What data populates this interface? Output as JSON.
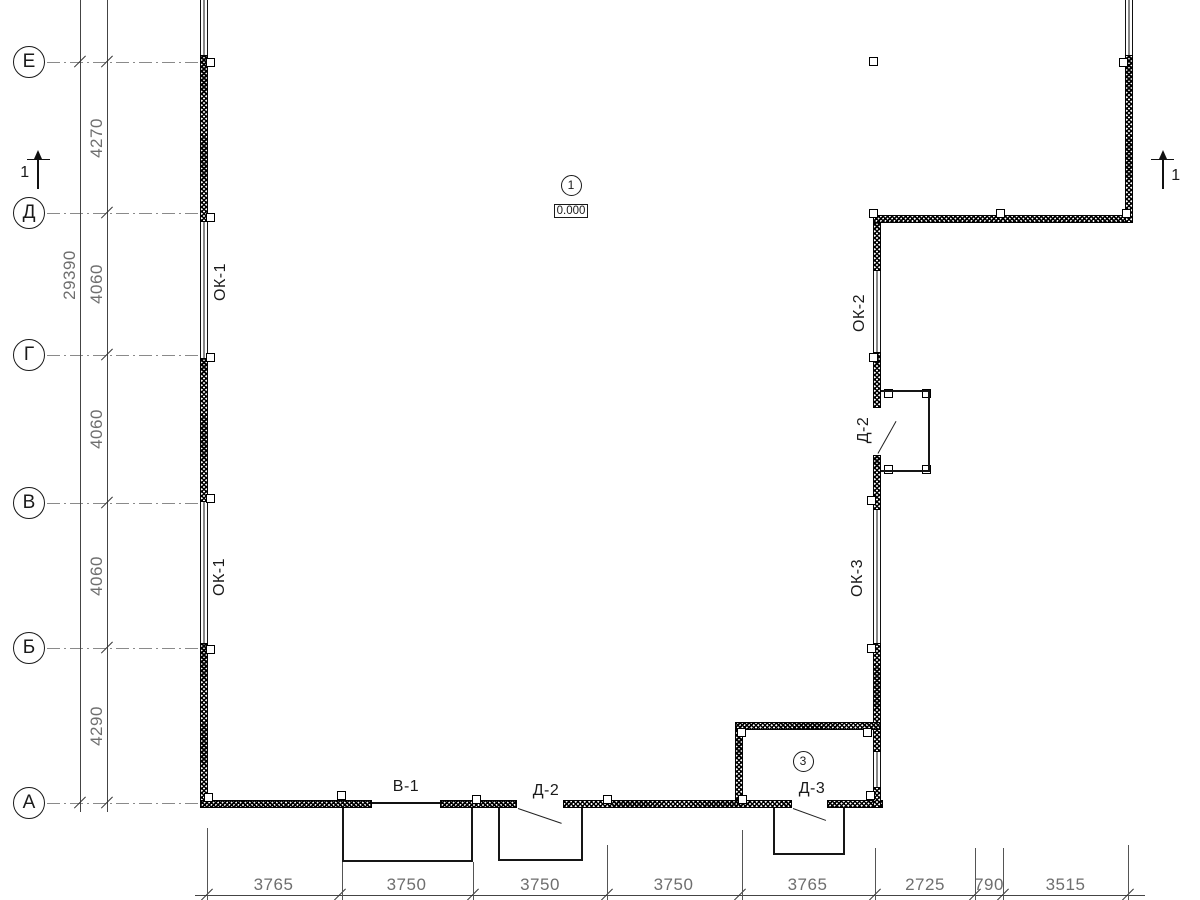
{
  "app": {
    "type": "architectural-floor-plan",
    "sheet_background": "#ffffff"
  },
  "plan": {
    "canvas": {
      "width": 1200,
      "height": 900,
      "ink": "#1a1a1a",
      "dim_color": "#6e6e6e",
      "axis_color": "#8a8a8a"
    },
    "axes": {
      "cx": 29,
      "r": 16,
      "line_x1": 47,
      "line_x2": 202,
      "items": [
        {
          "label": "Е",
          "y": 62
        },
        {
          "label": "Д",
          "y": 213
        },
        {
          "label": "Г",
          "y": 355
        },
        {
          "label": "В",
          "y": 503
        },
        {
          "label": "Б",
          "y": 648
        },
        {
          "label": "А",
          "y": 803
        }
      ]
    },
    "v_dims": {
      "line_x": 107,
      "bottom": 812,
      "text_x": 97,
      "ticks": [
        62,
        213,
        355,
        503,
        648,
        803
      ],
      "values": [
        "4270",
        "4060",
        "4060",
        "4060",
        "4290"
      ],
      "total": {
        "line_x": 80,
        "value": "29390",
        "text_cx": 70,
        "text_cy": 275,
        "ticks": [
          62,
          803
        ]
      }
    },
    "h_dims": {
      "line": [
        195,
        895,
        950
      ],
      "text_y": 885,
      "ticks": [
        207,
        340,
        473,
        607,
        740,
        875,
        975,
        1003,
        1128
      ],
      "values": [
        "3765",
        "3750",
        "3750",
        "3750",
        "3765",
        "2725",
        "790",
        "3515"
      ]
    },
    "section_marks": [
      {
        "label": "1",
        "bar": [
          27,
          158.5,
          23
        ],
        "line_x": 38,
        "line_y1": 150,
        "line_y2": 189,
        "label_cx": 25,
        "label_cy": 173
      },
      {
        "label": "1",
        "bar": [
          1151,
          158.5,
          23
        ],
        "line_x": 1163,
        "line_y1": 150,
        "line_y2": 189,
        "label_cx": 1176,
        "label_cy": 176
      }
    ],
    "level_mark": {
      "bubble_label": "1",
      "cx": 571,
      "cy": 185,
      "r": 10.5,
      "box": [
        554,
        204,
        34,
        14
      ],
      "elevation": "0.000"
    },
    "room_mark": {
      "label": "3",
      "cx": 803,
      "cy": 761,
      "r": 10.5
    },
    "labels": [
      {
        "name": "window-label-ok1-upper",
        "text": "ОК-1",
        "cx": 221,
        "cy": 282,
        "rot": -90
      },
      {
        "name": "window-label-ok1-lower",
        "text": "ОК-1",
        "cx": 220,
        "cy": 577,
        "rot": -90
      },
      {
        "name": "window-label-ok2",
        "text": "ОК-2",
        "cx": 860,
        "cy": 313,
        "rot": -90
      },
      {
        "name": "window-label-ok3",
        "text": "ОК-3",
        "cx": 858,
        "cy": 578,
        "rot": -90
      },
      {
        "name": "door-label-v1",
        "text": "В-1",
        "cx": 406,
        "cy": 787,
        "rot": 0
      },
      {
        "name": "door-label-d2-bottom",
        "text": "Д-2",
        "cx": 546,
        "cy": 791,
        "rot": 0
      },
      {
        "name": "door-label-d3",
        "text": "Д-3",
        "cx": 812,
        "cy": 789,
        "rot": 0
      },
      {
        "name": "door-label-d2-right",
        "text": "Д-2",
        "cx": 864,
        "cy": 430,
        "rot": -90
      }
    ],
    "walls": [
      [
        200,
        55,
        8,
        167
      ],
      [
        200,
        358,
        8,
        144
      ],
      [
        200,
        643,
        8,
        165
      ],
      [
        200,
        800,
        172,
        8
      ],
      [
        440,
        800,
        77,
        8
      ],
      [
        563,
        800,
        229,
        8
      ],
      [
        827,
        800,
        56,
        8
      ],
      [
        873,
        215,
        8,
        56
      ],
      [
        873,
        352,
        8,
        56
      ],
      [
        873,
        455,
        8,
        55
      ],
      [
        873,
        643,
        8,
        109
      ],
      [
        873,
        787,
        8,
        21
      ],
      [
        873,
        215,
        260,
        8
      ],
      [
        1125,
        55,
        8,
        168
      ],
      [
        735,
        722,
        146,
        8
      ],
      [
        735,
        730,
        8,
        70
      ]
    ],
    "windows": [
      {
        "name": "window-top-left",
        "r": [
          200,
          0,
          8,
          55
        ]
      },
      {
        "name": "window-ok1-upper",
        "r": [
          200,
          222,
          8,
          136
        ]
      },
      {
        "name": "window-ok1-lower",
        "r": [
          200,
          502,
          8,
          141
        ]
      },
      {
        "name": "window-ok2",
        "r": [
          873,
          271,
          8,
          81
        ]
      },
      {
        "name": "window-ok3",
        "r": [
          873,
          510,
          8,
          133
        ]
      },
      {
        "name": "window-vestibule",
        "r": [
          873,
          752,
          8,
          35
        ]
      },
      {
        "name": "window-top-right",
        "r": [
          1125,
          0,
          8,
          55
        ]
      }
    ],
    "columns": [
      [
        210,
        62
      ],
      [
        210,
        217
      ],
      [
        210,
        357
      ],
      [
        210,
        498
      ],
      [
        210,
        649
      ],
      [
        208,
        797
      ],
      [
        341,
        795
      ],
      [
        476,
        799
      ],
      [
        607,
        799
      ],
      [
        742,
        799
      ],
      [
        870,
        795
      ],
      [
        873,
        61
      ],
      [
        873,
        213
      ],
      [
        1000,
        213
      ],
      [
        1126,
        213
      ],
      [
        1123,
        62
      ],
      [
        873,
        357
      ],
      [
        871,
        500
      ],
      [
        871,
        648
      ],
      [
        867,
        732
      ],
      [
        741,
        732
      ],
      [
        888,
        393
      ],
      [
        926,
        393
      ],
      [
        888,
        469
      ],
      [
        926,
        469
      ]
    ],
    "porches": [
      [
        342,
        808,
        131,
        54
      ],
      [
        498,
        808,
        85,
        53
      ],
      [
        773,
        808,
        72,
        47
      ]
    ],
    "bumpout": [
      881,
      390,
      49,
      82
    ],
    "opening_lines": [
      [
        372,
        802,
        68,
        1.5
      ]
    ],
    "diag_lines": [
      {
        "name": "door-leaf-d2-bottom",
        "x1": 518,
        "y1": 808,
        "x2": 562,
        "y2": 823
      },
      {
        "name": "door-leaf-d3",
        "x1": 793,
        "y1": 808,
        "x2": 826,
        "y2": 820
      },
      {
        "name": "door-leaf-d2-right",
        "x1": 878,
        "y1": 453,
        "x2": 896,
        "y2": 421
      }
    ],
    "ext_lines": [
      [
        207,
        828,
        72
      ],
      [
        342,
        862,
        38
      ],
      [
        473,
        862,
        38
      ],
      [
        607,
        845,
        55
      ],
      [
        742,
        830,
        70
      ],
      [
        875,
        848,
        52
      ],
      [
        975,
        848,
        52
      ],
      [
        1003,
        848,
        52
      ],
      [
        1128,
        845,
        55
      ]
    ]
  }
}
